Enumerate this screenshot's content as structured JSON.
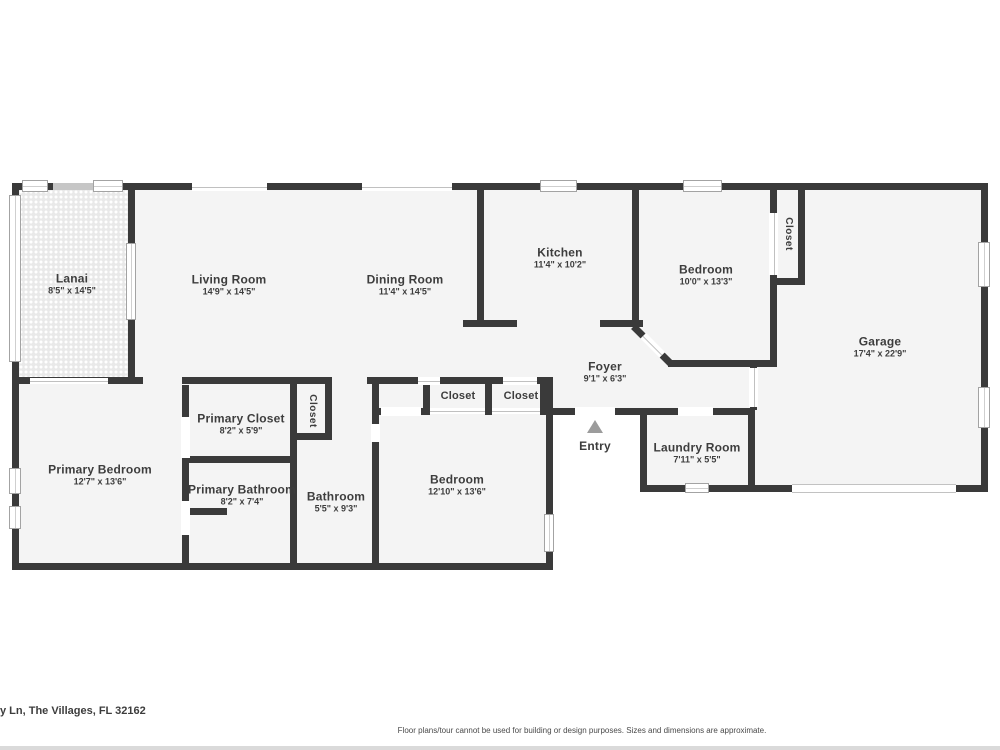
{
  "meta": {
    "address": "y Ln, The Villages, FL 32162",
    "disclaimer": "Floor plans/tour cannot be used for building or design purposes. Sizes and dimensions are approximate."
  },
  "colors": {
    "wall": "#3a3a3a",
    "room_fill": "#f4f4f4",
    "lanai_fill": "#e9e9e9",
    "label_text": "#3d3d3d",
    "entry_arrow": "#9c9c9c",
    "window_frame": "#a3a3a3",
    "footer_bar": "#dadada",
    "background": "#ffffff"
  },
  "rooms": [
    {
      "id": "lanai",
      "name": "Lanai",
      "dims": "8'5\" x 14'5\""
    },
    {
      "id": "living-room",
      "name": "Living Room",
      "dims": "14'9\" x 14'5\""
    },
    {
      "id": "dining-room",
      "name": "Dining Room",
      "dims": "11'4\" x 14'5\""
    },
    {
      "id": "kitchen",
      "name": "Kitchen",
      "dims": "11'4\" x 10'2\""
    },
    {
      "id": "bedroom-2",
      "name": "Bedroom",
      "dims": "10'0\" x 13'3\""
    },
    {
      "id": "bedroom-2-closet",
      "name": "Closet",
      "dims": ""
    },
    {
      "id": "garage",
      "name": "Garage",
      "dims": "17'4\" x 22'9\""
    },
    {
      "id": "foyer",
      "name": "Foyer",
      "dims": "9'1\" x 6'3\""
    },
    {
      "id": "entry",
      "name": "Entry",
      "dims": ""
    },
    {
      "id": "laundry-room",
      "name": "Laundry Room",
      "dims": "7'11\" x 5'5\""
    },
    {
      "id": "primary-bedroom",
      "name": "Primary Bedroom",
      "dims": "12'7\" x 13'6\""
    },
    {
      "id": "primary-closet",
      "name": "Primary Closet",
      "dims": "8'2\" x 5'9\""
    },
    {
      "id": "hall-closet",
      "name": "Closet",
      "dims": ""
    },
    {
      "id": "primary-bathroom",
      "name": "Primary Bathroom",
      "dims": "8'2\" x 7'4\""
    },
    {
      "id": "bathroom",
      "name": "Bathroom",
      "dims": "5'5\" x 9'3\""
    },
    {
      "id": "bedroom-3",
      "name": "Bedroom",
      "dims": "12'10\" x 13'6\""
    },
    {
      "id": "bedroom-3-closet",
      "name": "Closet",
      "dims": ""
    },
    {
      "id": "hall-closet-2",
      "name": "Closet",
      "dims": ""
    }
  ]
}
